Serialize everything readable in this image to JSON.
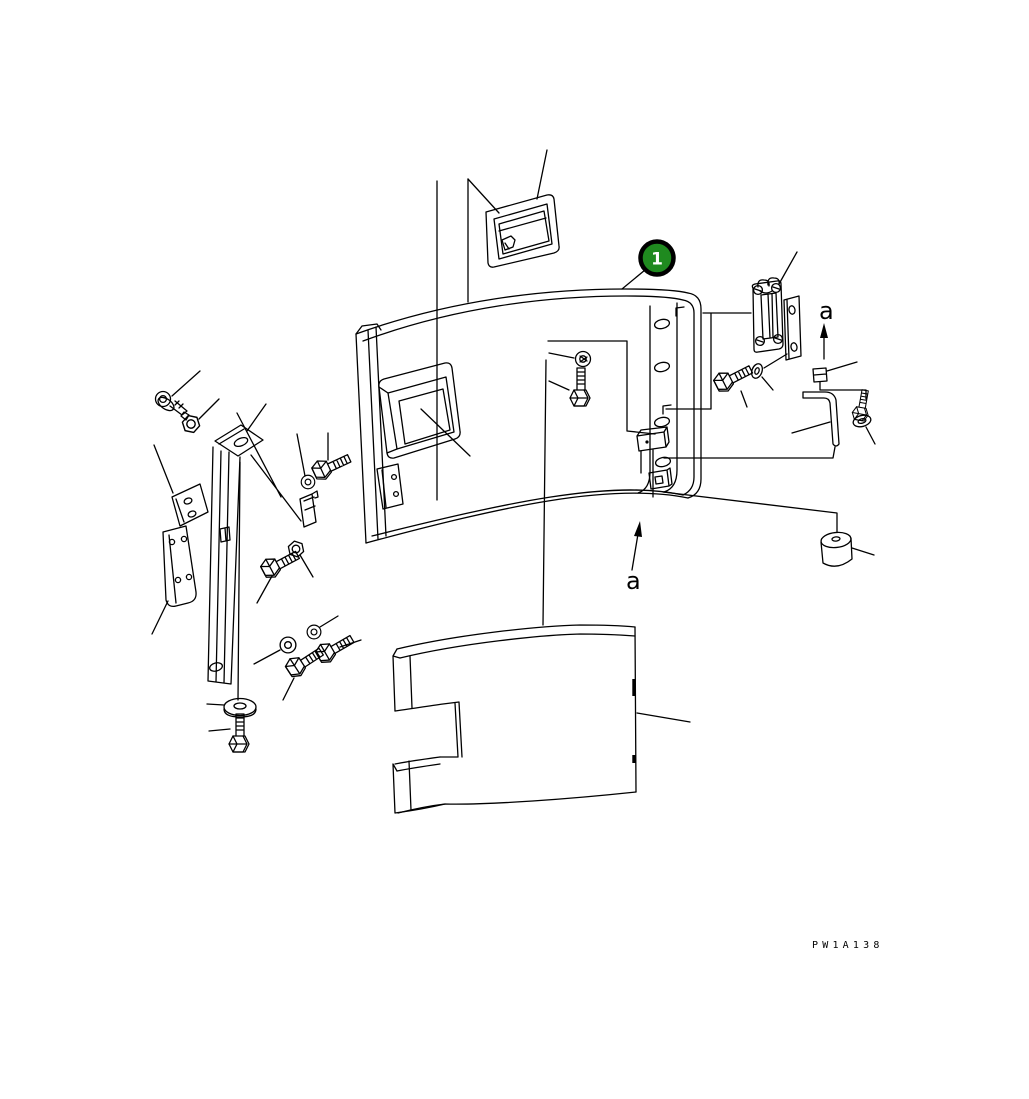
{
  "diagram": {
    "callouts": [
      {
        "label": "1"
      }
    ],
    "view_labels": {
      "top_right": "a",
      "bottom_center": "a"
    },
    "drawing_code": "PW1A138"
  },
  "colors": {
    "background": "#ffffff",
    "line": "#000000",
    "callout_fill": "#1f8a1f",
    "callout_border": "#000000",
    "callout_text": "#ffffff"
  }
}
